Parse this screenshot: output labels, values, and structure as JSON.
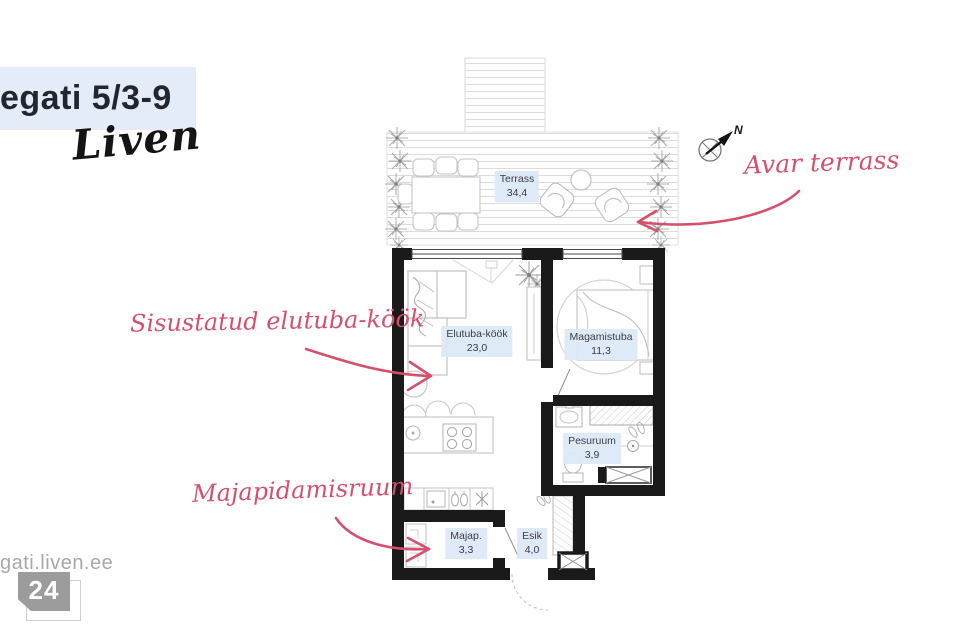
{
  "header": {
    "title": "egati 5/3-9",
    "brand": "Liven"
  },
  "plan": {
    "rooms": {
      "terrass": {
        "name": "Terrass",
        "area": "34,4"
      },
      "elutuba": {
        "name": "Elutuba-köök",
        "area": "23,0"
      },
      "magamistuba": {
        "name": "Magamistuba",
        "area": "11,3"
      },
      "pesuruum": {
        "name": "Pesuruum",
        "area": "3,9"
      },
      "majapidamisruum": {
        "name": "Majap.",
        "area": "3,3"
      },
      "esik": {
        "name": "Esik",
        "area": "4,0"
      }
    },
    "compass_label": "N"
  },
  "annotations": {
    "terrace": "Avar terrass",
    "living": "Sisustatud elutuba-köök",
    "utility": "Majapidamisruum"
  },
  "footer": {
    "watermark": "gati.liven.ee",
    "badge_number": "24"
  },
  "colors": {
    "accent_pink": "#d5506c",
    "label_bg": "#dde8f7",
    "header_bg": "#e4ecf9",
    "wall": "#1a1a1a"
  }
}
